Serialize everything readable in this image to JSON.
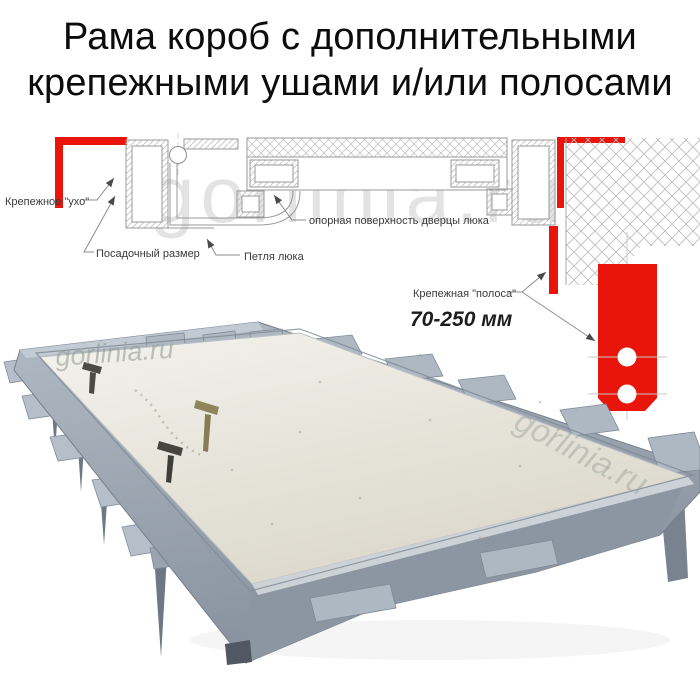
{
  "title": {
    "line1": "Рама короб с дополнительными",
    "line2": "крепежными ушами и/или полосами"
  },
  "watermark": "gorlinia.ru",
  "diagram": {
    "labels": {
      "ear": "Крепежное \"ухо\"",
      "seat_size": "Посадочный размер",
      "hinge": "Петля люка",
      "support_surface": "опорная поверхность дверцы люка",
      "strip": "Крепежная \"полоса\"",
      "strip_range": "70-250 мм"
    },
    "colors": {
      "accent_red": "#e9150b",
      "line_gray": "#8c8c8c"
    }
  },
  "photo": {
    "colors": {
      "frame_gray": "#98a2ae",
      "panel_cream": "#ecebe1"
    }
  }
}
